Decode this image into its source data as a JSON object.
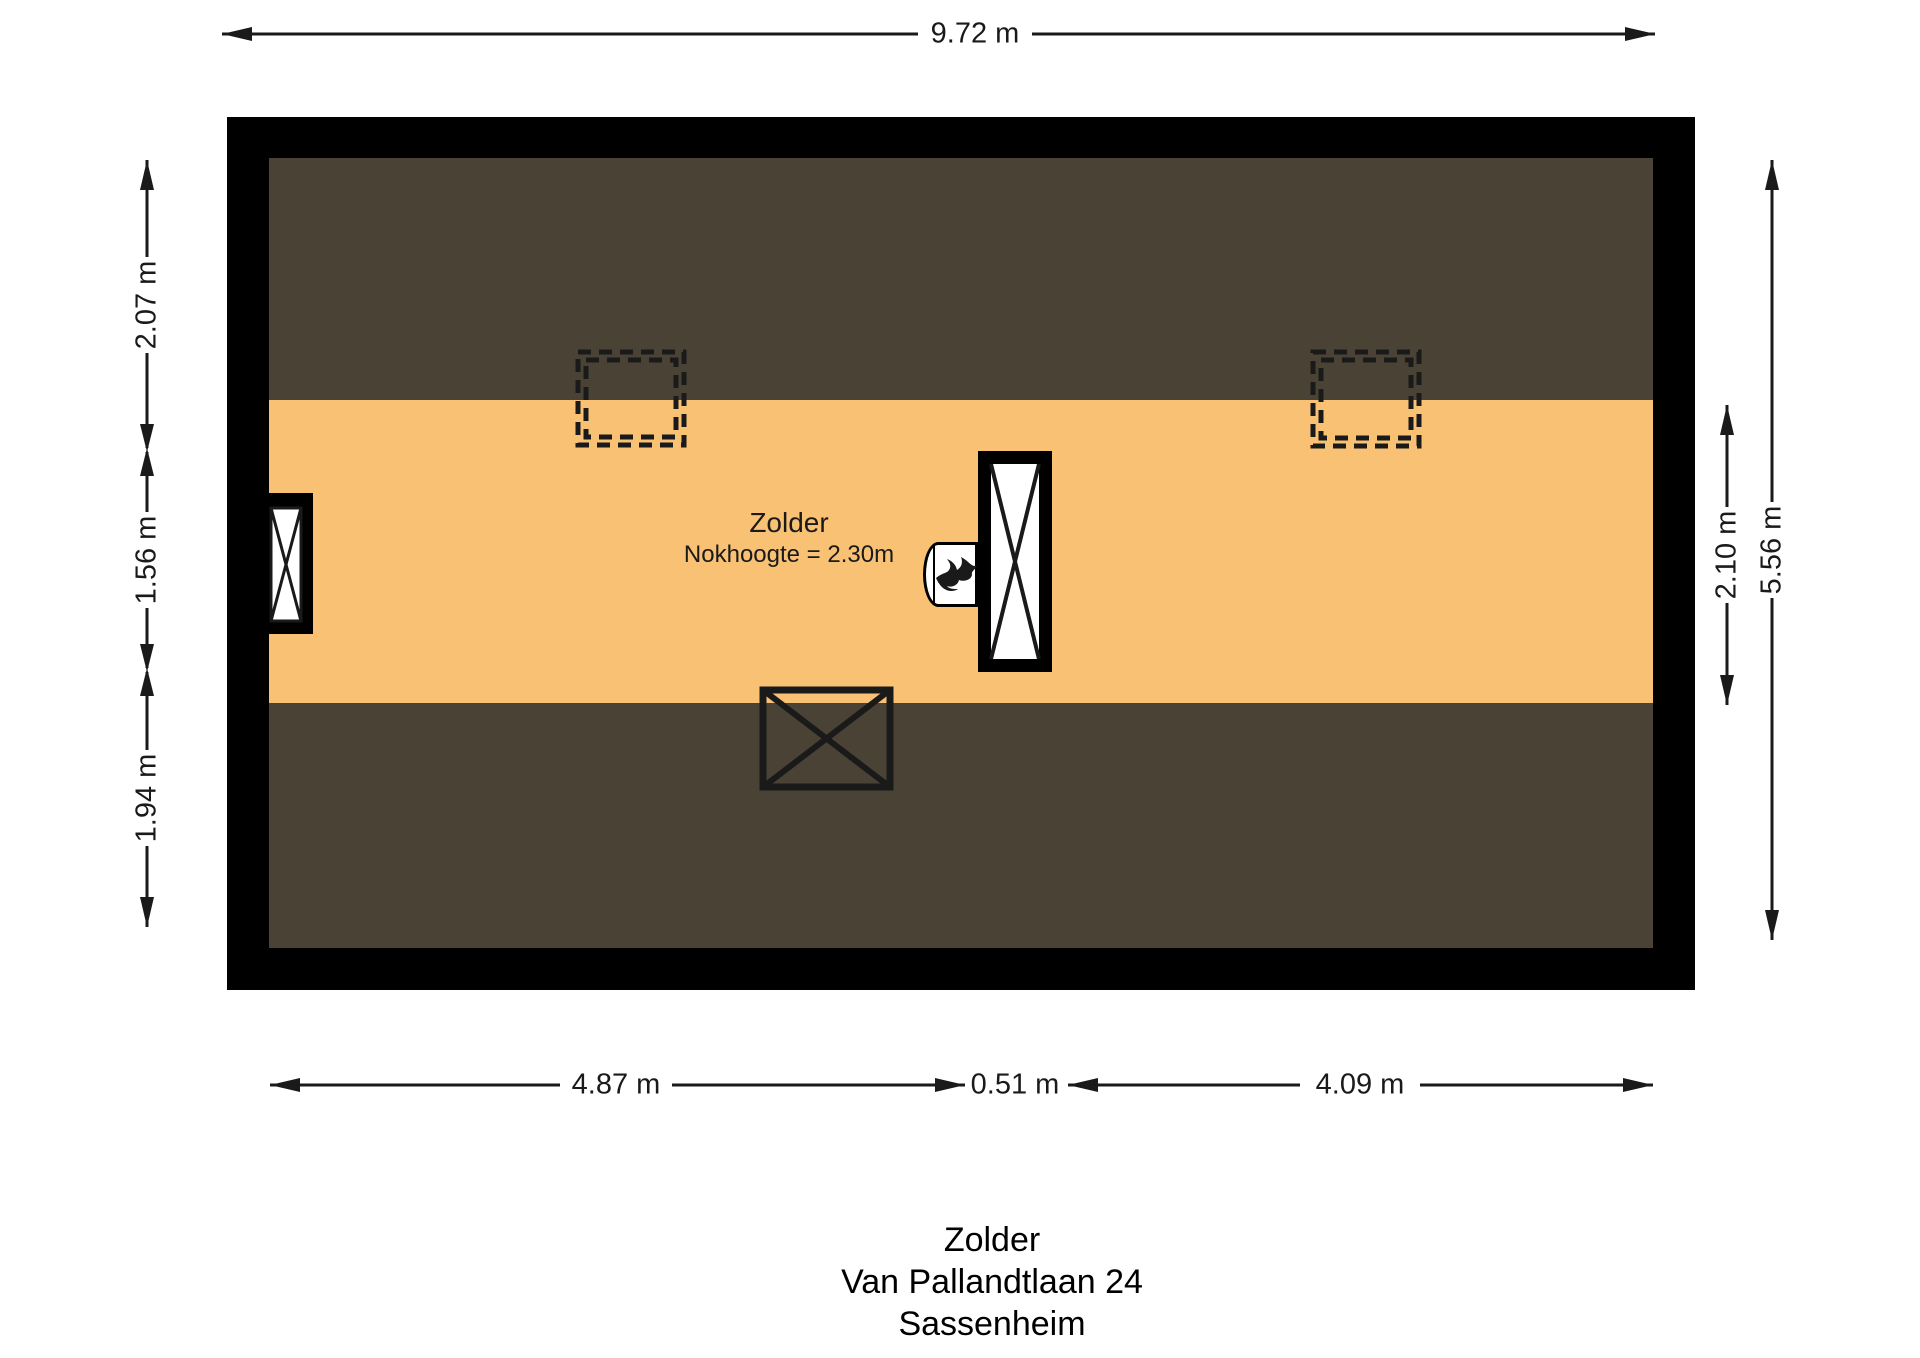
{
  "plan": {
    "room": {
      "name": "Zolder",
      "note": "Nokhoogte = 2.30m"
    },
    "dimensions": {
      "top": "9.72 m",
      "left": [
        "2.07 m",
        "1.56 m",
        "1.94 m"
      ],
      "right_inner": "2.10 m",
      "right_outer": "5.56 m",
      "bottom": [
        "4.87 m",
        "0.51 m",
        "4.09 m"
      ]
    },
    "features": {
      "skylight_count": 2,
      "flame_icon_meaning": "heating unit / boiler flue"
    }
  },
  "title_block": {
    "line1": "Zolder",
    "line2": "Van Pallandtlaan 24",
    "line3": "Sassenheim"
  },
  "colors": {
    "wall": "#000000",
    "roof": "#4b4236",
    "floor": "#f8c173",
    "line": "#1a1a1a",
    "background": "#ffffff"
  }
}
